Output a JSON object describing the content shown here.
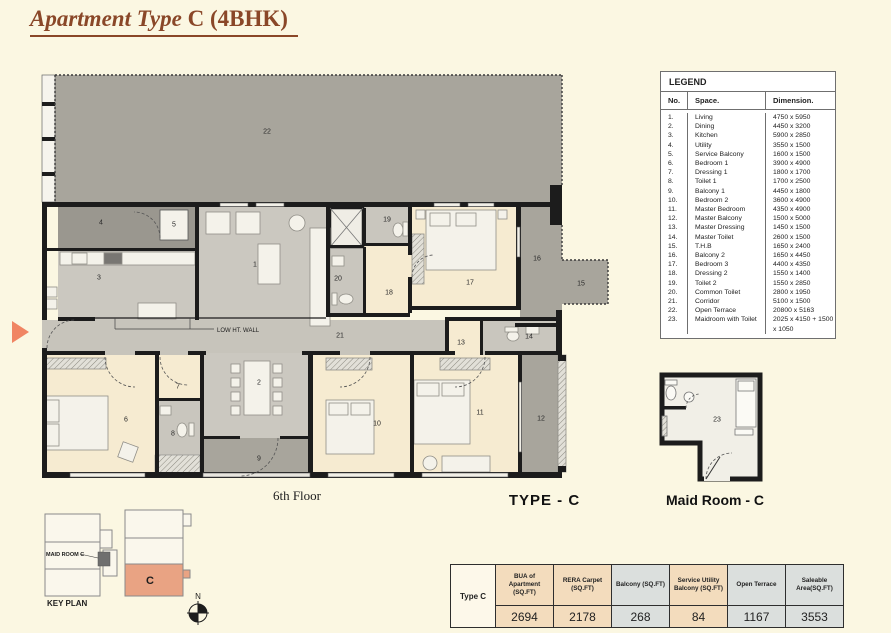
{
  "page": {
    "title_italic": "Apartment Type",
    "title_regular": " C (4BHK)",
    "floor_label": "6th Floor",
    "type_label": "TYPE - C",
    "maid_plan_label": "Maid Room - C",
    "key_plan_label": "KEY PLAN",
    "low_wall_label": "LOW HT. WALL",
    "compass_north": "N"
  },
  "colors": {
    "title_brown": "#8a4728",
    "key_unit_highlight": "#e9a383",
    "entry_arrow": "#f08563",
    "table_peach": "#f3dcbd",
    "table_gray": "#dbdfdd",
    "terrace_gray": "#a8a59c",
    "bedroom_cream": "#f6ebd1"
  },
  "plan": {
    "maid_room_number": "23",
    "room_numbers": [
      {
        "no": "1",
        "x": 245,
        "y": 203
      },
      {
        "no": "2",
        "x": 249,
        "y": 321
      },
      {
        "no": "3",
        "x": 89,
        "y": 216
      },
      {
        "no": "4",
        "x": 91,
        "y": 161
      },
      {
        "no": "5",
        "x": 164,
        "y": 163
      },
      {
        "no": "6",
        "x": 116,
        "y": 358
      },
      {
        "no": "7",
        "x": 168,
        "y": 325
      },
      {
        "no": "8",
        "x": 163,
        "y": 372
      },
      {
        "no": "9",
        "x": 249,
        "y": 397
      },
      {
        "no": "10",
        "x": 367,
        "y": 362
      },
      {
        "no": "11",
        "x": 470,
        "y": 351
      },
      {
        "no": "12",
        "x": 531,
        "y": 357
      },
      {
        "no": "13",
        "x": 451,
        "y": 281
      },
      {
        "no": "14",
        "x": 519,
        "y": 275
      },
      {
        "no": "15",
        "x": 571,
        "y": 222
      },
      {
        "no": "16",
        "x": 527,
        "y": 197
      },
      {
        "no": "17",
        "x": 460,
        "y": 221
      },
      {
        "no": "18",
        "x": 379,
        "y": 231
      },
      {
        "no": "19",
        "x": 377,
        "y": 158
      },
      {
        "no": "20",
        "x": 328,
        "y": 217
      },
      {
        "no": "21",
        "x": 330,
        "y": 274
      },
      {
        "no": "22",
        "x": 257,
        "y": 70
      }
    ]
  },
  "key_plan": {
    "unit_label": "C",
    "maid_room_label": "MAID ROOM C"
  },
  "legend": {
    "title": "LEGEND",
    "col_no": "No.",
    "col_space": "Space.",
    "col_dim": "Dimension.",
    "rows": [
      {
        "no": "1.",
        "space": "Living",
        "dim": "4750 x 5950"
      },
      {
        "no": "2.",
        "space": "Dining",
        "dim": "4450 x 3200"
      },
      {
        "no": "3.",
        "space": "Kitchen",
        "dim": "5900 x 2850"
      },
      {
        "no": "4.",
        "space": "Utility",
        "dim": "3550 x 1500"
      },
      {
        "no": "5.",
        "space": "Service Balcony",
        "dim": "1600 x 1500"
      },
      {
        "no": "6.",
        "space": "Bedroom 1",
        "dim": "3900 x 4900"
      },
      {
        "no": "7.",
        "space": "Dressing 1",
        "dim": "1800 x 1700"
      },
      {
        "no": "8.",
        "space": "Toilet 1",
        "dim": "1700 x 2500"
      },
      {
        "no": "9.",
        "space": "Balcony 1",
        "dim": "4450 x 1800"
      },
      {
        "no": "10.",
        "space": "Bedroom 2",
        "dim": "3600 x 4900"
      },
      {
        "no": "11.",
        "space": "Master Bedroom",
        "dim": "4350 x 4900"
      },
      {
        "no": "12.",
        "space": "Master Balcony",
        "dim": "1500 x 5000"
      },
      {
        "no": "13.",
        "space": "Master Dressing",
        "dim": "1450 x 1500"
      },
      {
        "no": "14.",
        "space": "Master Toilet",
        "dim": "2600 x 1500"
      },
      {
        "no": "15.",
        "space": "T.H.B",
        "dim": "1650 x 2400"
      },
      {
        "no": "16.",
        "space": "Balcony 2",
        "dim": "1650 x 4450"
      },
      {
        "no": "17.",
        "space": "Bedroom 3",
        "dim": "4400 x 4350"
      },
      {
        "no": "18.",
        "space": "Dressing 2",
        "dim": "1550 x 1400"
      },
      {
        "no": "19.",
        "space": "Toilet 2",
        "dim": "1550 x 2850"
      },
      {
        "no": "20.",
        "space": "Common Toilet",
        "dim": "2800 x 1950"
      },
      {
        "no": "21.",
        "space": "Corridor",
        "dim": "5100 x 1500"
      },
      {
        "no": "22.",
        "space": "Open Terrace",
        "dim": "20800 x 5163"
      },
      {
        "no": "23.",
        "space": "Maidroom with Toilet",
        "dim": "2025 x 4150 + 1500 x 1050"
      }
    ]
  },
  "area_table": {
    "row_label": "Type C",
    "columns": [
      {
        "label": "BUA of Apartment (SQ.FT)",
        "value": "2694",
        "tone": "peach"
      },
      {
        "label": "RERA Carpet (SQ.FT)",
        "value": "2178",
        "tone": "peach"
      },
      {
        "label": "Balcony (SQ.FT)",
        "value": "268",
        "tone": "gray"
      },
      {
        "label": "Service Utility Balcony (SQ.FT)",
        "value": "84",
        "tone": "peach"
      },
      {
        "label": "Open Terrace",
        "value": "1167",
        "tone": "gray"
      },
      {
        "label": "Saleable Area(SQ.FT)",
        "value": "3553",
        "tone": "gray"
      }
    ]
  }
}
